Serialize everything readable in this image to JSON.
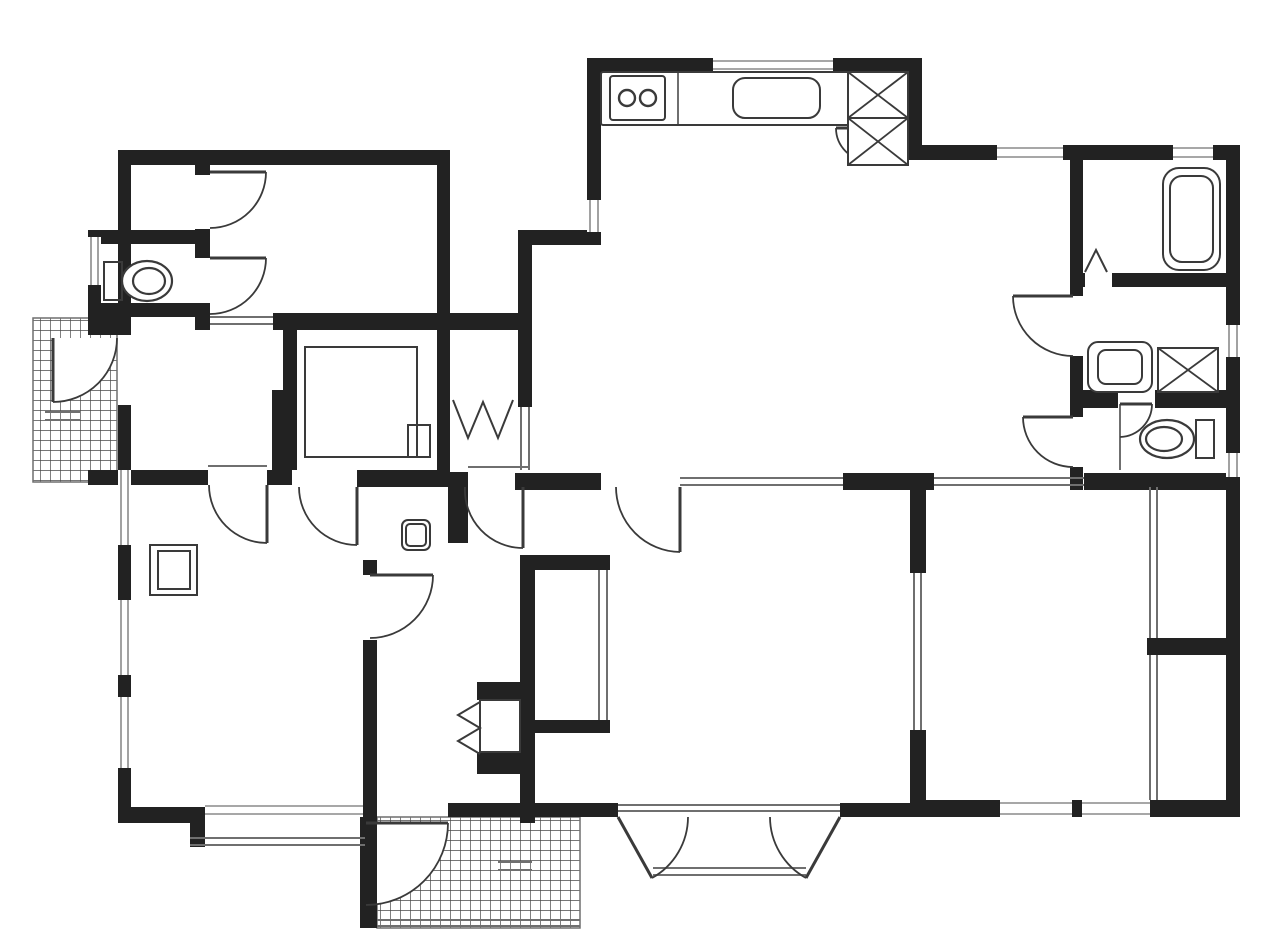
{
  "canvas": {
    "w": 1280,
    "h": 943,
    "bg": "#ffffff"
  },
  "colors": {
    "wall": "#222222",
    "line": "#3a3a3a",
    "thin": "#6f6f6f",
    "window": "#8a8a8a",
    "hatch": "#4a4a4a",
    "paper": "#ffffff"
  },
  "floor_plan": {
    "walls": [
      [
        118,
        150,
        332,
        15
      ],
      [
        118,
        165,
        13,
        170
      ],
      [
        118,
        405,
        13,
        418
      ],
      [
        88,
        230,
        122,
        14
      ],
      [
        88,
        244,
        13,
        73
      ],
      [
        88,
        303,
        122,
        14
      ],
      [
        88,
        317,
        30,
        18
      ],
      [
        195,
        165,
        15,
        10
      ],
      [
        195,
        229,
        15,
        29
      ],
      [
        195,
        315,
        15,
        15
      ],
      [
        273,
        313,
        259,
        17
      ],
      [
        283,
        330,
        14,
        140
      ],
      [
        437,
        150,
        13,
        323
      ],
      [
        272,
        390,
        16,
        95
      ],
      [
        88,
        470,
        120,
        15
      ],
      [
        267,
        470,
        25,
        15
      ],
      [
        357,
        470,
        93,
        17
      ],
      [
        448,
        472,
        20,
        71
      ],
      [
        518,
        232,
        14,
        175
      ],
      [
        518,
        230,
        83,
        15
      ],
      [
        587,
        58,
        14,
        142
      ],
      [
        587,
        58,
        335,
        14
      ],
      [
        908,
        58,
        14,
        102
      ],
      [
        908,
        145,
        32,
        15
      ],
      [
        922,
        145,
        318,
        15
      ],
      [
        1226,
        145,
        14,
        672
      ],
      [
        1070,
        160,
        13,
        113
      ],
      [
        1070,
        273,
        15,
        14
      ],
      [
        1112,
        273,
        128,
        14
      ],
      [
        1070,
        287,
        13,
        9
      ],
      [
        1070,
        356,
        13,
        61
      ],
      [
        1070,
        467,
        13,
        23
      ],
      [
        1083,
        390,
        35,
        18
      ],
      [
        1155,
        390,
        85,
        18
      ],
      [
        515,
        473,
        86,
        17
      ],
      [
        843,
        473,
        91,
        17
      ],
      [
        1084,
        473,
        156,
        17
      ],
      [
        910,
        487,
        16,
        86
      ],
      [
        910,
        730,
        16,
        87
      ],
      [
        1147,
        638,
        93,
        17
      ],
      [
        915,
        800,
        325,
        17
      ],
      [
        448,
        803,
        170,
        14
      ],
      [
        840,
        803,
        90,
        14
      ],
      [
        360,
        803,
        17,
        125
      ],
      [
        520,
        555,
        90,
        15
      ],
      [
        520,
        555,
        15,
        268
      ],
      [
        520,
        720,
        90,
        13
      ],
      [
        363,
        560,
        14,
        15
      ],
      [
        363,
        640,
        14,
        163
      ],
      [
        477,
        682,
        45,
        18
      ],
      [
        477,
        752,
        45,
        22
      ],
      [
        118,
        807,
        87,
        16
      ],
      [
        190,
        807,
        15,
        40
      ]
    ],
    "windows_v": [
      [
        118,
        470,
        13,
        75
      ],
      [
        118,
        600,
        13,
        75
      ],
      [
        118,
        697,
        13,
        71
      ],
      [
        88,
        237,
        13,
        48
      ],
      [
        587,
        200,
        14,
        32
      ],
      [
        1226,
        325,
        14,
        32
      ],
      [
        1226,
        453,
        14,
        24
      ]
    ],
    "windows_h": [
      [
        713,
        58,
        120,
        14
      ],
      [
        997,
        145,
        66,
        15
      ],
      [
        1173,
        145,
        40,
        15
      ],
      [
        1000,
        800,
        72,
        17
      ],
      [
        1082,
        800,
        68,
        17
      ],
      [
        205,
        803,
        158,
        14
      ]
    ],
    "thin_lines": [
      [
        680,
        478,
        843,
        478
      ],
      [
        680,
        485,
        843,
        485
      ],
      [
        934,
        478,
        1084,
        478
      ],
      [
        934,
        485,
        1084,
        485
      ],
      [
        914,
        573,
        914,
        730
      ],
      [
        921,
        573,
        921,
        730
      ],
      [
        1150,
        487,
        1150,
        638
      ],
      [
        1157,
        487,
        1157,
        638
      ],
      [
        1150,
        655,
        1150,
        800
      ],
      [
        1157,
        655,
        1157,
        800
      ],
      [
        599,
        570,
        599,
        720
      ],
      [
        607,
        570,
        607,
        720
      ],
      [
        210,
        317,
        273,
        317
      ],
      [
        210,
        324,
        273,
        324
      ],
      [
        521,
        407,
        521,
        470
      ],
      [
        529,
        407,
        529,
        470
      ],
      [
        208,
        466,
        267,
        466
      ],
      [
        468,
        467,
        530,
        467
      ],
      [
        618,
        805,
        840,
        805
      ],
      [
        618,
        811,
        840,
        811
      ],
      [
        653,
        868,
        806,
        868
      ],
      [
        653,
        875,
        806,
        875
      ],
      [
        190,
        838,
        365,
        838
      ],
      [
        190,
        845,
        365,
        845
      ],
      [
        45,
        412,
        80,
        412
      ],
      [
        45,
        420,
        80,
        420
      ],
      [
        498,
        862,
        532,
        862
      ],
      [
        498,
        870,
        532,
        870
      ],
      [
        377,
        920,
        580,
        920
      ],
      [
        377,
        926,
        580,
        926
      ],
      [
        678,
        72,
        678,
        125
      ],
      [
        1120,
        404,
        1120,
        470
      ]
    ],
    "doors": [
      {
        "name": "closet-door",
        "leaf": [
          210,
          172,
          266,
          172
        ],
        "arc": [
          266,
          172,
          56,
          210,
          228,
          1
        ],
        "sector": 0
      },
      {
        "name": "toilet-door",
        "leaf": [
          210,
          258,
          266,
          258
        ],
        "arc": [
          266,
          258,
          56,
          210,
          314,
          1
        ],
        "sector": 0
      },
      {
        "name": "entry-side-door",
        "leaf": [
          53,
          338,
          53,
          402
        ],
        "arc": [
          117,
          338,
          64,
          53,
          402,
          1
        ],
        "sector": 1
      },
      {
        "name": "hall-room-door",
        "leaf": [
          267,
          485,
          267,
          543
        ],
        "arc": [
          209,
          485,
          58,
          267,
          543,
          0
        ],
        "sector": 0
      },
      {
        "name": "hall-room-door",
        "leaf": [
          357,
          487,
          357,
          545
        ],
        "arc": [
          299,
          487,
          58,
          357,
          545,
          0
        ],
        "sector": 0
      },
      {
        "name": "hall-door",
        "leaf": [
          523,
          487,
          523,
          548
        ],
        "arc": [
          465,
          487,
          58,
          523,
          548,
          0
        ],
        "sector": 0
      },
      {
        "name": "ldk-room-door",
        "leaf": [
          680,
          487,
          680,
          552
        ],
        "arc": [
          616,
          487,
          65,
          680,
          552,
          0
        ],
        "sector": 0
      },
      {
        "name": "washroom-door",
        "leaf": [
          1073,
          296,
          1013,
          296
        ],
        "arc": [
          1013,
          296,
          60,
          1073,
          356,
          0
        ],
        "sector": 0
      },
      {
        "name": "toilet-lobby-door",
        "leaf": [
          1073,
          417,
          1023,
          417
        ],
        "arc": [
          1023,
          417,
          50,
          1073,
          467,
          0
        ],
        "sector": 0
      },
      {
        "name": "toilet-door",
        "leaf": [
          1120,
          404,
          1152,
          404
        ],
        "arc": [
          1152,
          404,
          33,
          1120,
          437,
          1
        ],
        "sector": 0
      },
      {
        "name": "middle-room-door",
        "leaf": [
          370,
          575,
          433,
          575
        ],
        "arc": [
          433,
          575,
          63,
          370,
          638,
          1
        ],
        "sector": 0
      },
      {
        "name": "kitchen-cabinet-door",
        "leaf": [
          869,
          128,
          836,
          128
        ],
        "arc": [
          836,
          128,
          33,
          869,
          161,
          0
        ],
        "sector": 0
      },
      {
        "name": "french-door-left",
        "leaf": [
          618,
          817,
          652,
          878
        ],
        "arc": [
          652,
          878,
          70,
          688,
          817,
          0
        ],
        "sector": 0
      },
      {
        "name": "french-door-right",
        "leaf": [
          840,
          817,
          806,
          878
        ],
        "arc": [
          806,
          878,
          70,
          770,
          817,
          1
        ],
        "sector": 0
      },
      {
        "name": "genkan-door",
        "leaf": [
          366,
          823,
          448,
          823
        ],
        "arc": [
          448,
          823,
          82,
          366,
          905,
          1
        ],
        "sector": 1
      }
    ],
    "hatches": [
      {
        "name": "entry-porch-tile",
        "x": 33,
        "y": 318,
        "w": 84,
        "h": 164
      },
      {
        "name": "genkan-tile",
        "x": 377,
        "y": 817,
        "w": 203,
        "h": 111
      }
    ],
    "fixtures": [
      {
        "t": "rrect",
        "n": "kitchen-counter",
        "x": 601,
        "y": 72,
        "w": 307,
        "h": 53,
        "rx": 2,
        "f": 0
      },
      {
        "t": "rrect",
        "n": "stove",
        "x": 610,
        "y": 76,
        "w": 55,
        "h": 44,
        "rx": 3,
        "f": 1
      },
      {
        "t": "circle",
        "n": "stove-burner",
        "cx": 627,
        "cy": 98,
        "r": 8
      },
      {
        "t": "circle",
        "n": "stove-burner",
        "cx": 648,
        "cy": 98,
        "r": 8
      },
      {
        "t": "rrect",
        "n": "kitchen-sink",
        "x": 733,
        "y": 78,
        "w": 87,
        "h": 40,
        "rx": 12,
        "f": 1
      },
      {
        "t": "xbox",
        "n": "refrigerator-space",
        "x": 848,
        "y": 72,
        "w": 60,
        "h": 46
      },
      {
        "t": "xbox",
        "n": "storage-space",
        "x": 848,
        "y": 118,
        "w": 60,
        "h": 47
      },
      {
        "t": "rrect",
        "n": "bathtub",
        "x": 1163,
        "y": 168,
        "w": 57,
        "h": 102,
        "rx": 16,
        "f": 1
      },
      {
        "t": "rrect",
        "n": "bathtub-inner",
        "x": 1170,
        "y": 176,
        "w": 43,
        "h": 86,
        "rx": 12,
        "f": 0
      },
      {
        "t": "rrect",
        "n": "washbasin",
        "x": 1088,
        "y": 342,
        "w": 64,
        "h": 50,
        "rx": 10,
        "f": 1
      },
      {
        "t": "rrect",
        "n": "washbasin-inner",
        "x": 1098,
        "y": 350,
        "w": 44,
        "h": 34,
        "rx": 8,
        "f": 0
      },
      {
        "t": "xbox",
        "n": "washing-machine",
        "x": 1158,
        "y": 348,
        "w": 60,
        "h": 44
      },
      {
        "t": "rect",
        "n": "toilet-tank",
        "x": 104,
        "y": 262,
        "w": 18,
        "h": 38
      },
      {
        "t": "ell",
        "n": "toilet-bowl",
        "cx": 147,
        "cy": 281,
        "rx": 25,
        "ry": 20
      },
      {
        "t": "ell",
        "n": "toilet-bowl-inner",
        "cx": 149,
        "cy": 281,
        "rx": 16,
        "ry": 13
      },
      {
        "t": "rect",
        "n": "toilet-tank",
        "x": 1196,
        "y": 420,
        "w": 18,
        "h": 38
      },
      {
        "t": "ell",
        "n": "toilet-bowl",
        "cx": 1167,
        "cy": 439,
        "rx": 27,
        "ry": 19
      },
      {
        "t": "ell",
        "n": "toilet-bowl-inner",
        "cx": 1164,
        "cy": 439,
        "rx": 18,
        "ry": 12
      },
      {
        "t": "rrect",
        "n": "hall-basin",
        "x": 402,
        "y": 520,
        "w": 28,
        "h": 30,
        "rx": 6,
        "f": 1
      },
      {
        "t": "rrect",
        "n": "hall-basin-inner",
        "x": 406,
        "y": 524,
        "w": 20,
        "h": 22,
        "rx": 4,
        "f": 0
      },
      {
        "t": "rect",
        "n": "cabinet",
        "x": 150,
        "y": 545,
        "w": 47,
        "h": 50
      },
      {
        "t": "rect",
        "n": "cabinet-inner",
        "x": 158,
        "y": 551,
        "w": 32,
        "h": 38
      },
      {
        "t": "rect",
        "n": "storage-room-outline",
        "x": 305,
        "y": 347,
        "w": 112,
        "h": 110
      },
      {
        "t": "rect",
        "n": "storage-shelf",
        "x": 408,
        "y": 425,
        "w": 22,
        "h": 32
      },
      {
        "t": "rect",
        "n": "closet-box",
        "x": 480,
        "y": 700,
        "w": 40,
        "h": 52
      },
      {
        "t": "poly",
        "n": "bifold-door",
        "pts": [
          453,
          400,
          468,
          438,
          483,
          402,
          498,
          438,
          513,
          400
        ]
      },
      {
        "t": "poly",
        "n": "bifold-door",
        "pts": [
          480,
          702,
          458,
          715,
          480,
          728,
          458,
          741,
          480,
          754
        ]
      },
      {
        "t": "poly",
        "n": "folding-door",
        "pts": [
          1085,
          272,
          1096,
          250,
          1107,
          272
        ]
      }
    ]
  }
}
